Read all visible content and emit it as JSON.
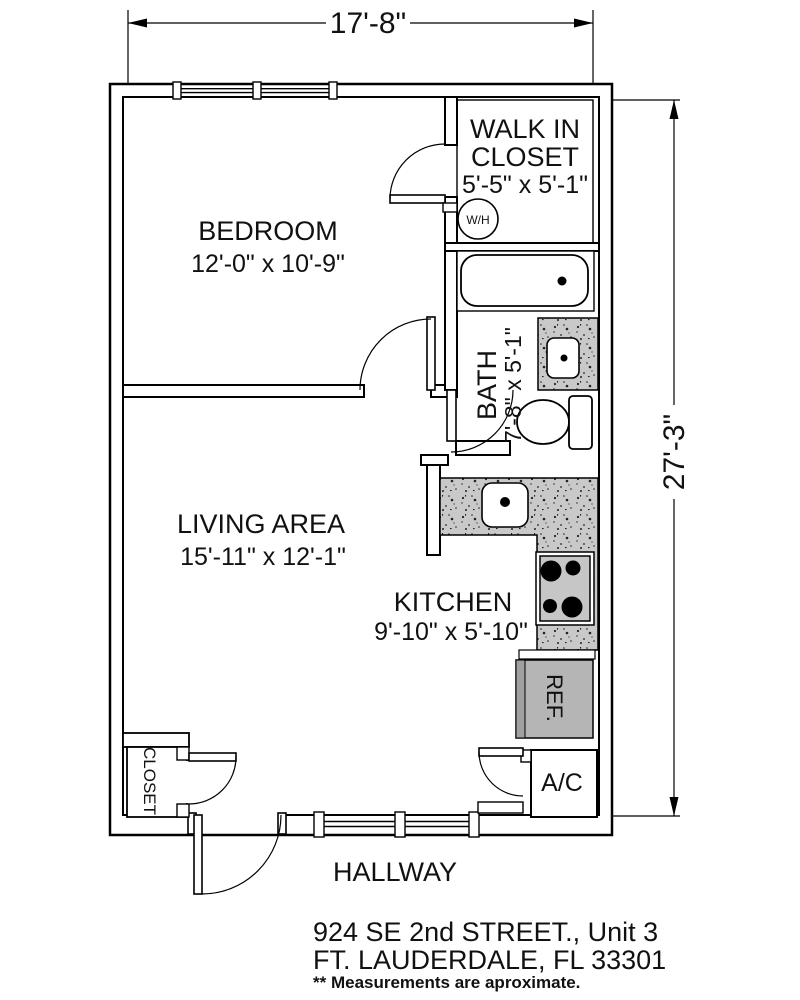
{
  "plan_title": "Floor plan - 924 SE 2nd Street Unit 3",
  "dimensions": {
    "width_overall": "17'-8\"",
    "height_overall": "27'-3\""
  },
  "rooms": {
    "bedroom": {
      "name": "BEDROOM",
      "dims": "12'-0\" x 10'-9\""
    },
    "walk_in_closet": {
      "name_line1": "WALK IN",
      "name_line2": "CLOSET",
      "dims": "5'-5\" x 5'-1\""
    },
    "bath": {
      "name": "BATH",
      "dims": "7'-8\" x 5'-1\""
    },
    "living": {
      "name": "LIVING AREA",
      "dims": "15'-11\" x 12'-1\""
    },
    "kitchen": {
      "name": "KITCHEN",
      "dims": "9'-10\" x 5'-10\""
    },
    "hallway": {
      "name": "HALLWAY"
    },
    "closet": {
      "name": "CLOSET"
    }
  },
  "fixtures": {
    "water_heater": "W/H",
    "refrigerator": "REF.",
    "air_conditioner": "A/C"
  },
  "title_block": {
    "address_line1": "924 SE 2nd STREET., Unit 3",
    "address_line2": "FT. LAUDERDALE, FL 33301",
    "disclaimer": "** Measurements are aproximate."
  },
  "colors": {
    "line": "#000000",
    "counter_gray": "#c9c9c9",
    "ref_gray": "#b5b5b5",
    "background": "#ffffff"
  }
}
